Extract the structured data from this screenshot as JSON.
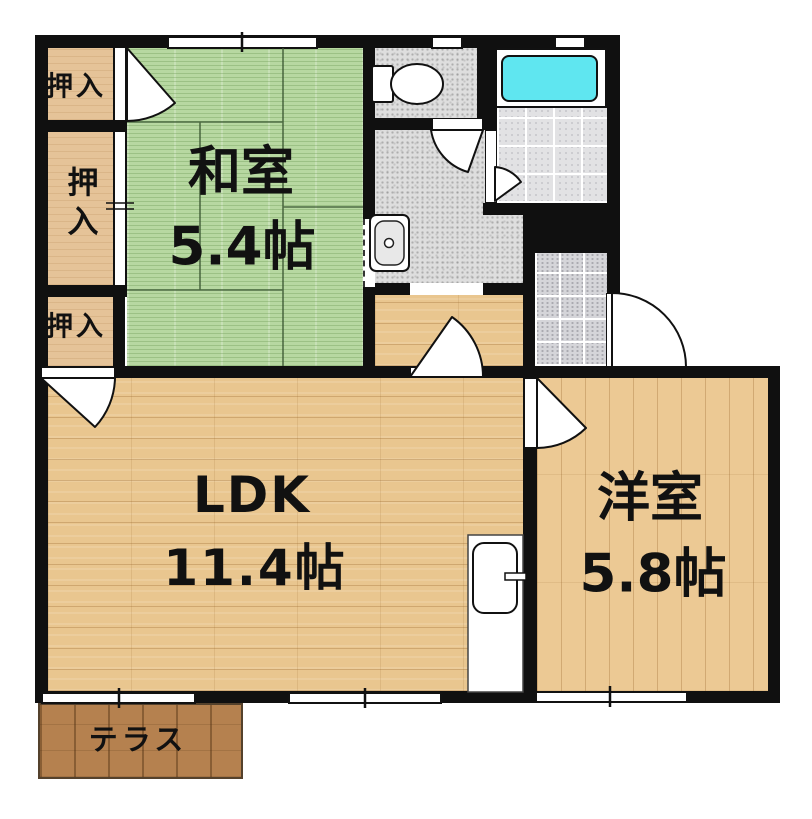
{
  "plan": {
    "type": "apartment-floor-plan",
    "rooms": {
      "washitsu": {
        "name": "和室",
        "size": "5.4帖"
      },
      "ldk": {
        "name": "LDK",
        "size": "11.4帖"
      },
      "youshitsu": {
        "name": "洋室",
        "size": "5.8帖"
      },
      "terrace": {
        "name": "テラス"
      },
      "closet_top": {
        "name": "押入"
      },
      "closet_middle": {
        "name": "押入"
      },
      "closet_bottom": {
        "name": "押入"
      }
    },
    "fixtures": [
      "toilet-icon",
      "bathtub-icon",
      "washbasin-icon",
      "kitchen-sink-icon"
    ],
    "colors": {
      "wall": "#101010",
      "tatami": "#b7d8a1",
      "wood_floor": "#e9c68f",
      "closet_wood": "#e5c398",
      "terrace_wood": "#b5814f",
      "tile_grey": "#dedede",
      "bathtub_cyan": "#5fe6f0",
      "background": "#ffffff"
    }
  }
}
